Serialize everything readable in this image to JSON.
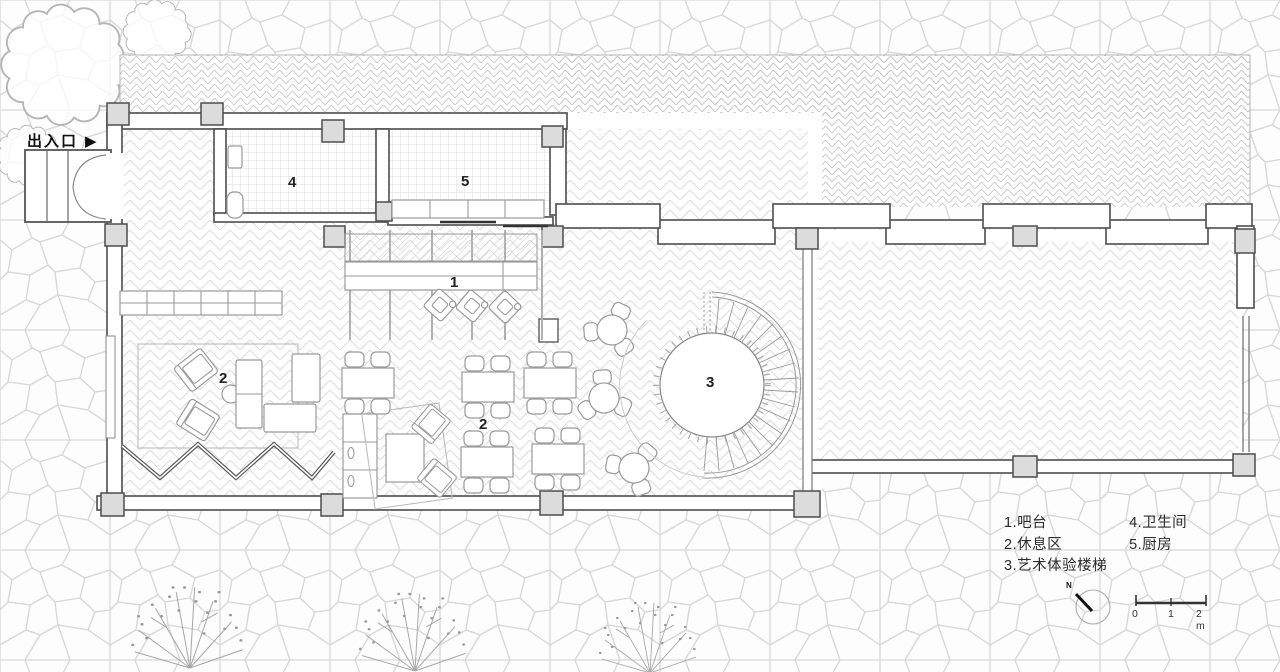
{
  "entrance": {
    "label": "出入口",
    "arrow": "▶"
  },
  "rooms": {
    "bar": "1",
    "lounge_west": "2",
    "lounge_center": "2",
    "art_stair": "3",
    "restroom": "4",
    "kitchen": "5"
  },
  "legend": {
    "items": [
      {
        "text": "1.吧台"
      },
      {
        "text": "2.休息区"
      },
      {
        "text": "3.艺术体验楼梯"
      },
      {
        "text": "4.卫生间"
      },
      {
        "text": "5.厨房"
      }
    ]
  },
  "north": {
    "label": "N"
  },
  "scale": {
    "ticks": [
      "0",
      "1",
      "2 m"
    ]
  },
  "colors": {
    "wall": "#4d4d4d",
    "column_fill": "#dcdcdc",
    "floor_pattern": "#dcdcdc",
    "terrace_pattern": "#c6c6c6",
    "stone_outline": "#d8d8d8",
    "furniture_outline": "#9a9a9a",
    "label_text": "#222222",
    "scale_bar": "#333333"
  }
}
